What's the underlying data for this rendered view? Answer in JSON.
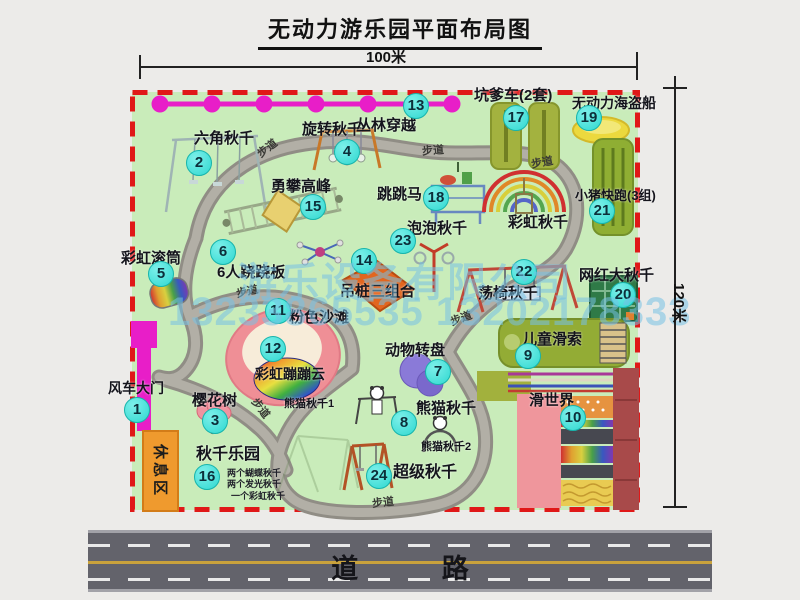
{
  "title": "无动力游乐园平面布局图",
  "dimensions": {
    "width_label": "100米",
    "height_label": "120米"
  },
  "road": {
    "label": "道 路"
  },
  "watermark": {
    "line1": "游乐设备有限公司",
    "line2": "13233865535 13202178333"
  },
  "rest_area": {
    "label": "休息区"
  },
  "walkway_label": "步道",
  "attractions": [
    {
      "no": "1",
      "name": "风车大门"
    },
    {
      "no": "2",
      "name": "六角秋千"
    },
    {
      "no": "3",
      "name": "樱花树"
    },
    {
      "no": "4",
      "name": "旋转秋千"
    },
    {
      "no": "5",
      "name": "彩虹滚筒"
    },
    {
      "no": "6",
      "name": "6人跷跷板"
    },
    {
      "no": "7",
      "name": "动物转盘"
    },
    {
      "no": "8",
      "name": "熊猫秋千"
    },
    {
      "no": "9",
      "name": "儿童滑索"
    },
    {
      "no": "10",
      "name": "滑世界"
    },
    {
      "no": "11",
      "name": "粉色沙滩"
    },
    {
      "no": "12",
      "name": "彩虹蹦蹦云"
    },
    {
      "no": "13",
      "name": "丛林穿越"
    },
    {
      "no": "14",
      "name": "吊桩三组合"
    },
    {
      "no": "15",
      "name": "勇攀高峰"
    },
    {
      "no": "16",
      "name": "秋千乐园"
    },
    {
      "no": "17",
      "name": "坑爹车(2套)"
    },
    {
      "no": "18",
      "name": "跳跳马"
    },
    {
      "no": "19",
      "name": "无动力海盗船"
    },
    {
      "no": "20",
      "name": "网红大秋千"
    },
    {
      "no": "21",
      "name": "小猪快跑(3组)"
    },
    {
      "no": "22",
      "name": "荡椅秋千"
    },
    {
      "no": "23",
      "name": "泡泡秋千"
    },
    {
      "no": "24",
      "name": "超级秋千"
    }
  ],
  "extra_labels": {
    "rainbow_swing": "彩虹秋千",
    "panda1": "熊猫秋千1",
    "panda2": "熊猫秋千2",
    "swing_note1": "两个蝴蝶秋千",
    "swing_note2": "两个发光秋千",
    "swing_note3": "一个彩虹秋千"
  },
  "colors": {
    "park_green": "#c9ecba",
    "border_red": "#e01818",
    "path_gray": "#a7a49c",
    "badge_cyan": "#3fe3dc",
    "gate_magenta": "#e81ec8",
    "road_gray": "#63636b",
    "rest_orange": "#ef9a2e"
  }
}
